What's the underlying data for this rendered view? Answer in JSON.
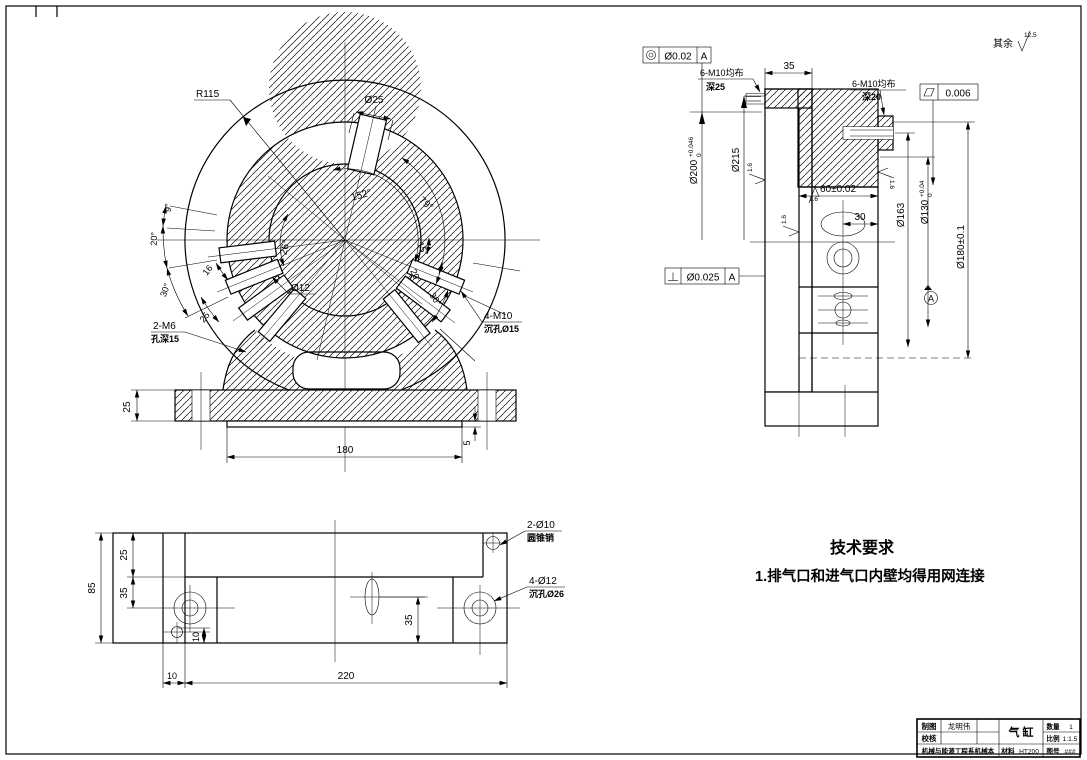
{
  "colors": {
    "line": "#000000",
    "background": "#ffffff"
  },
  "general_roughness": {
    "prefix": "其余",
    "value": "12.5"
  },
  "front_view": {
    "r115": "R115",
    "d25": "Ø25",
    "d12": "Ø12",
    "a152": "152°",
    "a79": "79°",
    "a26": "26°",
    "a9": "9°",
    "a20_left": "20°",
    "a30_left": "30°",
    "w16": "16",
    "w25": "25",
    "a15_right": "15°",
    "a20_right": "20°",
    "a30_right": "30°",
    "m6_label": "2-M6",
    "m6_depth": "孔深15",
    "m10_label": "4-M10",
    "m10_cbore": "沉孔Ø15",
    "dim_180": "180",
    "dim_25": "25",
    "dim_5": "5"
  },
  "section_view": {
    "fcf_concentricity": {
      "value": "Ø0.02",
      "datum": "A"
    },
    "fcf_flatness": {
      "value": "0.006"
    },
    "fcf_perpendicularity": {
      "value": "Ø0.025",
      "datum": "A"
    },
    "m10_left": "6-M10均布",
    "m10_left_depth": "深25",
    "m10_right": "6-M10均布",
    "m10_right_depth": "深20",
    "dim_35": "35",
    "dim_60": "60±0.02",
    "dim_30": "30",
    "d200": "Ø200",
    "d200_up": "+0.046",
    "d200_dn": "0",
    "d215": "Ø215",
    "d163": "Ø163",
    "d130": "Ø130",
    "d130_up": "+0.04",
    "d130_dn": "0",
    "d180": "Ø180±0.1",
    "datum_a": "A",
    "finish": "1.6"
  },
  "bottom_view": {
    "dim_85": "85",
    "dim_25": "25",
    "dim_35_left": "35",
    "dim_10_left": "10",
    "dim_10_bottom": "10",
    "dim_220": "220",
    "dim_35_right": "35",
    "pin_label": "2-Ø10",
    "pin_note": "圆锥销",
    "cbore_label": "4-Ø12",
    "cbore_note": "沉孔Ø26"
  },
  "tech_requirements": {
    "title": "技术要求",
    "item_1": "1.排气口和进气口内壁均得用网连接"
  },
  "title_block": {
    "drawn_label": "制图",
    "drawn_name": "龙明伟",
    "checked_label": "校核",
    "org": "机械与能源工程系机械本",
    "part_name": "气 缸",
    "qty_label": "数量",
    "qty_value": "1",
    "scale_label": "比例",
    "scale_value": "1:1.5",
    "material_label": "材料",
    "material_value": "HT200",
    "dwgno_label": "图号",
    "dwgno_value": "###"
  }
}
